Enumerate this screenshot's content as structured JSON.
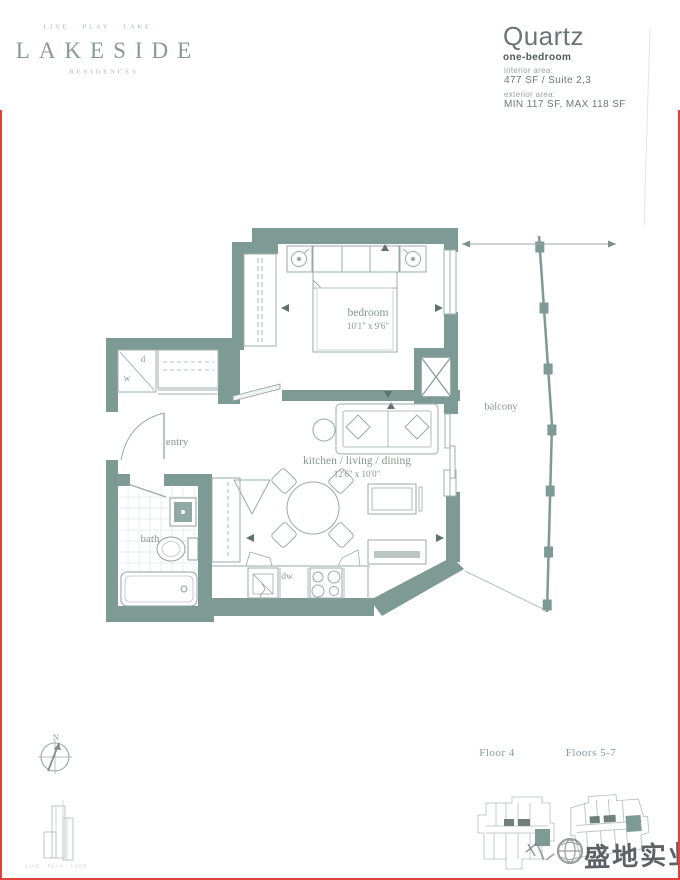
{
  "brand": {
    "tagline": "LIVE . PLAY . LAKE .",
    "name": "LAKESIDE",
    "residences": "RESIDENCES"
  },
  "unit": {
    "name": "Quartz",
    "type": "one-bedroom",
    "interior_label": "interior area:",
    "interior_value": "477 SF / Suite 2,3",
    "exterior_label": "exterior area:",
    "exterior_value": "MIN 117 SF, MAX 118 SF"
  },
  "plan": {
    "rooms": {
      "bedroom": {
        "label": "bedroom",
        "dims": "10'1\" x 9'6\""
      },
      "living": {
        "label": "kitchen / living / dining",
        "dims": "12'6\" x 10'0\""
      },
      "bath": {
        "label": "bath"
      },
      "entry": {
        "label": "entry"
      },
      "balcony": {
        "label": "balcony"
      }
    },
    "fixtures": {
      "washer": "w",
      "dryer": "d",
      "dishwasher": "dw"
    }
  },
  "compass": {
    "north": "N"
  },
  "footer": {
    "tagline": "LIVE . PLAY . LAKE .",
    "keyplan_left_label": "Floor 4",
    "keyplan_right_label": "Floors 5-7"
  },
  "watermark": {
    "text": "盛地实业"
  },
  "colors": {
    "wall": "#7e9a94",
    "furniture_line": "#9aaba6",
    "label_text": "#87988f",
    "keyplan_highlight": "#7e9a94",
    "border": "#e0413a"
  }
}
